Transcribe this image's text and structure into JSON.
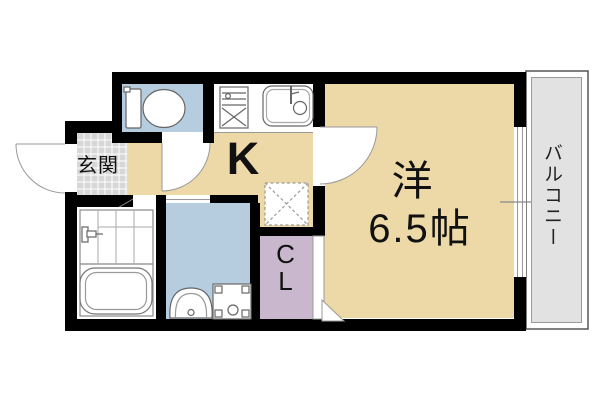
{
  "plan_title": "1K apartment floor plan",
  "labels": {
    "entrance": "玄関",
    "kitchen": "K",
    "room": "洋",
    "room_size": "6.5帖",
    "closet": "CL",
    "balcony": "バルコニー"
  },
  "colors": {
    "wall": "#000000",
    "room_tan": "#ecd9a7",
    "wet_blue": "#b5cdde",
    "closet_purple": "#c9b7cd",
    "entrance_tile": "#d7d7d7",
    "balcony_gray": "#e2e2e2",
    "fixture_line": "#666666"
  },
  "fixtures": [
    "toilet",
    "stove",
    "kitchen-sink",
    "refrigerator-space",
    "bathtub",
    "shower-faucet",
    "washbasin",
    "washing-machine-pan"
  ],
  "doors": [
    "entrance-swing-door",
    "toilet-swing-door",
    "kitchen-swing-door",
    "bathroom-folding-door",
    "washroom-sliding-door",
    "closet-sliding-door",
    "balcony-window"
  ]
}
